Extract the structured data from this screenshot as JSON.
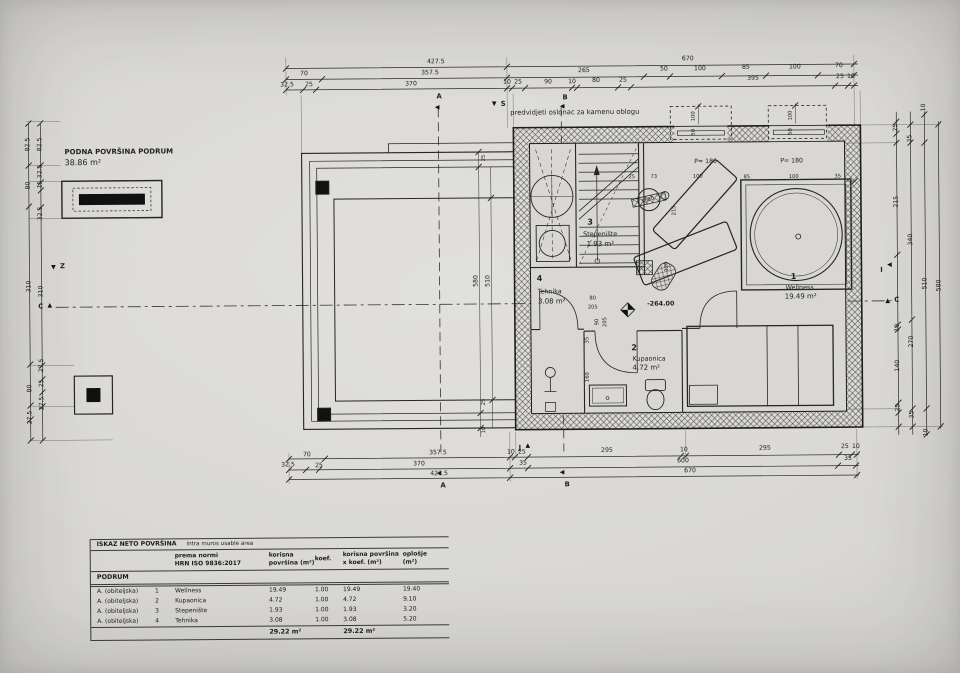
{
  "drawing": {
    "note_top": "predvidjeti oslonac za kamenu oblogu",
    "floor_area": {
      "title": "PODNA POVRŠINA PODRUM",
      "value": "38.86 m²"
    },
    "elevation": "-264.00",
    "rooms": [
      {
        "num": "1",
        "name": "Wellness",
        "area": "19.49 m²"
      },
      {
        "num": "2",
        "name": "Kupaonica",
        "area": "4.72 m²"
      },
      {
        "num": "3",
        "name": "Stepenište",
        "area": "1.93 m²"
      },
      {
        "num": "4",
        "name": "Tehnika",
        "area": "3.08 m²"
      }
    ],
    "windows": {
      "parapet": "P= 180",
      "well_w": "100",
      "well_h": "50"
    },
    "doors": {
      "d1_w": "80",
      "d1_h": "205",
      "d2_w": "90",
      "d2_h": "205"
    },
    "equip_label": "1650",
    "markers": {
      "a": "A",
      "b": "B",
      "c": "C",
      "i": "I",
      "j": "J",
      "s": "S",
      "z": "Z"
    }
  },
  "dims": {
    "top1": [
      "427.5",
      "670"
    ],
    "top2": [
      "70",
      "357.5",
      "265",
      "50",
      "100",
      "85",
      "100",
      "70"
    ],
    "top3": [
      "32.5",
      "25",
      "370",
      "10",
      "25",
      "90",
      "10",
      "80",
      "25",
      "395",
      "25",
      "10"
    ],
    "bot1": [
      "70",
      "357.5",
      "10",
      "25",
      "295",
      "10",
      "295",
      "25",
      "10"
    ],
    "bot2": [
      "32.5",
      "25",
      "370",
      "35",
      "600",
      "35"
    ],
    "bot3": [
      "427.5",
      "670"
    ],
    "left_outer": [
      "82.5",
      "80",
      "310",
      "80",
      "27.5"
    ],
    "left_inner": [
      "82.5",
      "32.5",
      "15",
      "32.5",
      "310",
      "27.5",
      "25",
      "27.5"
    ],
    "right_a": [
      "25",
      "215",
      "10",
      "140",
      "25"
    ],
    "right_b": [
      "35",
      "340",
      "270",
      "35"
    ],
    "right_c": [
      "10",
      "510",
      "10"
    ],
    "right_d": [
      "580"
    ],
    "wing": [
      "25",
      "580",
      "510",
      "25",
      "10"
    ],
    "inner_top": [
      "25",
      "73",
      "100",
      "85",
      "100",
      "35"
    ],
    "inner_v": [
      "215",
      "120",
      "35",
      "160"
    ]
  },
  "table": {
    "title": "ISKAZ NETO POVRŠINA",
    "subtitle": "intra muros usable area",
    "col_norm_1": "prema normi",
    "col_norm_2": "HRN ISO 9836:2017",
    "col_area_1": "korisna",
    "col_area_2": "površina (m²)",
    "col_koef": "koef.",
    "col_areak_1": "korisna površina",
    "col_areak_2": "x koef. (m²)",
    "col_opl_1": "oplošje",
    "col_opl_2": "(m²)",
    "section": "PODRUM",
    "rows": [
      {
        "cat": "A. (obiteljska)",
        "num": "1",
        "name": "Wellness",
        "area": "19.49",
        "koef": "1.00",
        "areak": "19.49",
        "opl": "19.40"
      },
      {
        "cat": "A. (obiteljska)",
        "num": "2",
        "name": "Kupaonica",
        "area": "4.72",
        "koef": "1.00",
        "areak": "4.72",
        "opl": "9.10"
      },
      {
        "cat": "A. (obiteljska)",
        "num": "3",
        "name": "Stepenište",
        "area": "1.93",
        "koef": "1.00",
        "areak": "1.93",
        "opl": "3.20"
      },
      {
        "cat": "A. (obiteljska)",
        "num": "4",
        "name": "Tehnika",
        "area": "3.08",
        "koef": "1.00",
        "areak": "3.08",
        "opl": "5.20"
      }
    ],
    "total_area": "29.22 m²",
    "total_areak": "29.22 m²"
  }
}
